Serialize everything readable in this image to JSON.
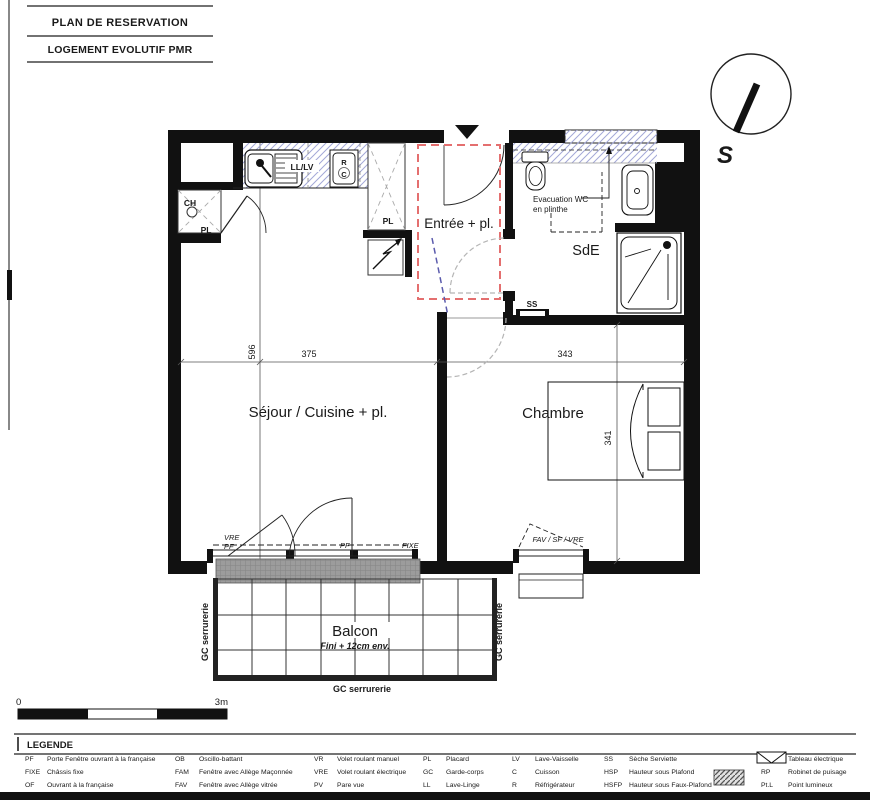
{
  "titles": {
    "t1": "PLAN DE RESERVATION",
    "t2": "LOGEMENT EVOLUTIF PMR"
  },
  "compass": {
    "s": "S"
  },
  "rooms": {
    "entree": "Entrée + pl.",
    "sde": "SdE",
    "sejour": "Séjour / Cuisine + pl.",
    "chambre": "Chambre",
    "balcon": "Balcon",
    "balcon_note": "Fini + 12cm env."
  },
  "notes": {
    "evac1": "Evacuation WC",
    "evac2": "en plinthe",
    "ss": "SS",
    "ll_lv": "LL/LV",
    "r": "R",
    "c": "C",
    "pl_top": "PL",
    "pl_ch": "PL",
    "ch": "CH",
    "vre": "VRE",
    "pf1": "PF",
    "pf2": "PF",
    "fixe": "FIXE",
    "fav": "FAV / SF / VRE",
    "gc_l": "GC serrurerie",
    "gc_r": "GC serrurerie",
    "gc_b": "GC serrurerie"
  },
  "dims": {
    "d596": "596",
    "d375": "375",
    "d343": "343",
    "d341": "341"
  },
  "scalebar": {
    "zero": "0",
    "max": "3m"
  },
  "colors": {
    "red_dashed": "#e46f6f",
    "blue_hatch": "#a3a8d8",
    "blue_dashed": "#5b5bad",
    "gray_arc": "#b5b5b5"
  },
  "legend": {
    "title": "LEGENDE",
    "cols": [
      {
        "items": [
          {
            "abbr": "PF",
            "label": "Porte Fenêtre ouvrant à la française"
          },
          {
            "abbr": "FIXE",
            "label": "Châssis fixe"
          },
          {
            "abbr": "OF",
            "label": "Ouvrant à la française"
          }
        ]
      },
      {
        "items": [
          {
            "abbr": "OB",
            "label": "Oscillo-battant"
          },
          {
            "abbr": "FAM",
            "label": "Fenêtre avec Allège Maçonnée"
          },
          {
            "abbr": "FAV",
            "label": "Fenêtre avec Allège vitrée"
          }
        ]
      },
      {
        "items": [
          {
            "abbr": "VR",
            "label": "Volet roulant manuel"
          },
          {
            "abbr": "VRE",
            "label": "Volet roulant électrique"
          },
          {
            "abbr": "PV",
            "label": "Pare vue"
          }
        ]
      },
      {
        "items": [
          {
            "abbr": "PL",
            "label": "Placard"
          },
          {
            "abbr": "GC",
            "label": "Garde-corps"
          },
          {
            "abbr": "LL",
            "label": "Lave-Linge"
          }
        ]
      },
      {
        "items": [
          {
            "abbr": "LV",
            "label": "Lave-Vaisselle"
          },
          {
            "abbr": "C",
            "label": "Cuisson"
          },
          {
            "abbr": "R",
            "label": "Réfrigérateur"
          }
        ]
      },
      {
        "items": [
          {
            "abbr": "SS",
            "label": "Sèche Serviette"
          },
          {
            "abbr": "HSP",
            "label": "Hauteur sous Plafond"
          },
          {
            "abbr": "HSFP",
            "label": "Hauteur sous Faux-Plafond"
          }
        ]
      },
      {
        "items": [
          {
            "abbr": "",
            "label": "Tableau électrique"
          },
          {
            "abbr": "RP",
            "label": "Robinet de puisage"
          },
          {
            "abbr": "Pt.L",
            "label": "Point lumineux"
          }
        ]
      }
    ]
  }
}
